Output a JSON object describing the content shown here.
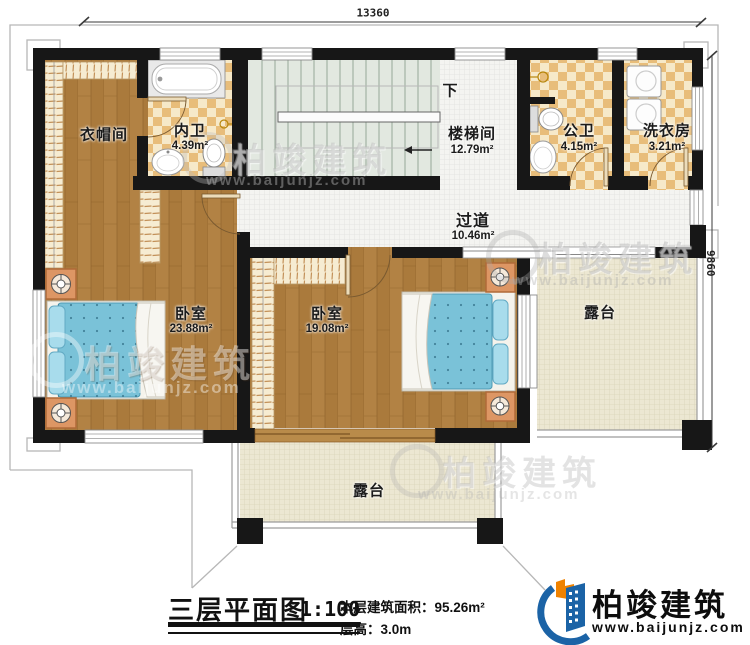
{
  "dimensions": {
    "top": "13360",
    "right": "9860"
  },
  "stairs": {
    "direction_label": "下"
  },
  "rooms": {
    "cloakroom": {
      "name": "衣帽间"
    },
    "inner_bath": {
      "name": "内卫",
      "area": "4.39m²"
    },
    "stairwell": {
      "name": "楼梯间",
      "area": "12.79m²"
    },
    "public_bath": {
      "name": "公卫",
      "area": "4.15m²"
    },
    "laundry": {
      "name": "洗衣房",
      "area": "3.21m²"
    },
    "corridor": {
      "name": "过道",
      "area": "10.46m²"
    },
    "bedroom_left": {
      "name": "卧室",
      "area": "23.88m²"
    },
    "bedroom_right": {
      "name": "卧室",
      "area": "19.08m²"
    },
    "terrace_right": {
      "name": "露台"
    },
    "terrace_bottom": {
      "name": "露台"
    }
  },
  "title_block": {
    "plan_title": "三层平面图",
    "scale": "1:100",
    "floor_area": "本层建筑面积：95.26m²",
    "floor_height": "层高：3.0m"
  },
  "brand": {
    "name": "柏竣建筑",
    "website": "www.baijunjz.com"
  },
  "watermark": {
    "name": "柏竣建筑",
    "website": "www.baijunjz.com"
  }
}
